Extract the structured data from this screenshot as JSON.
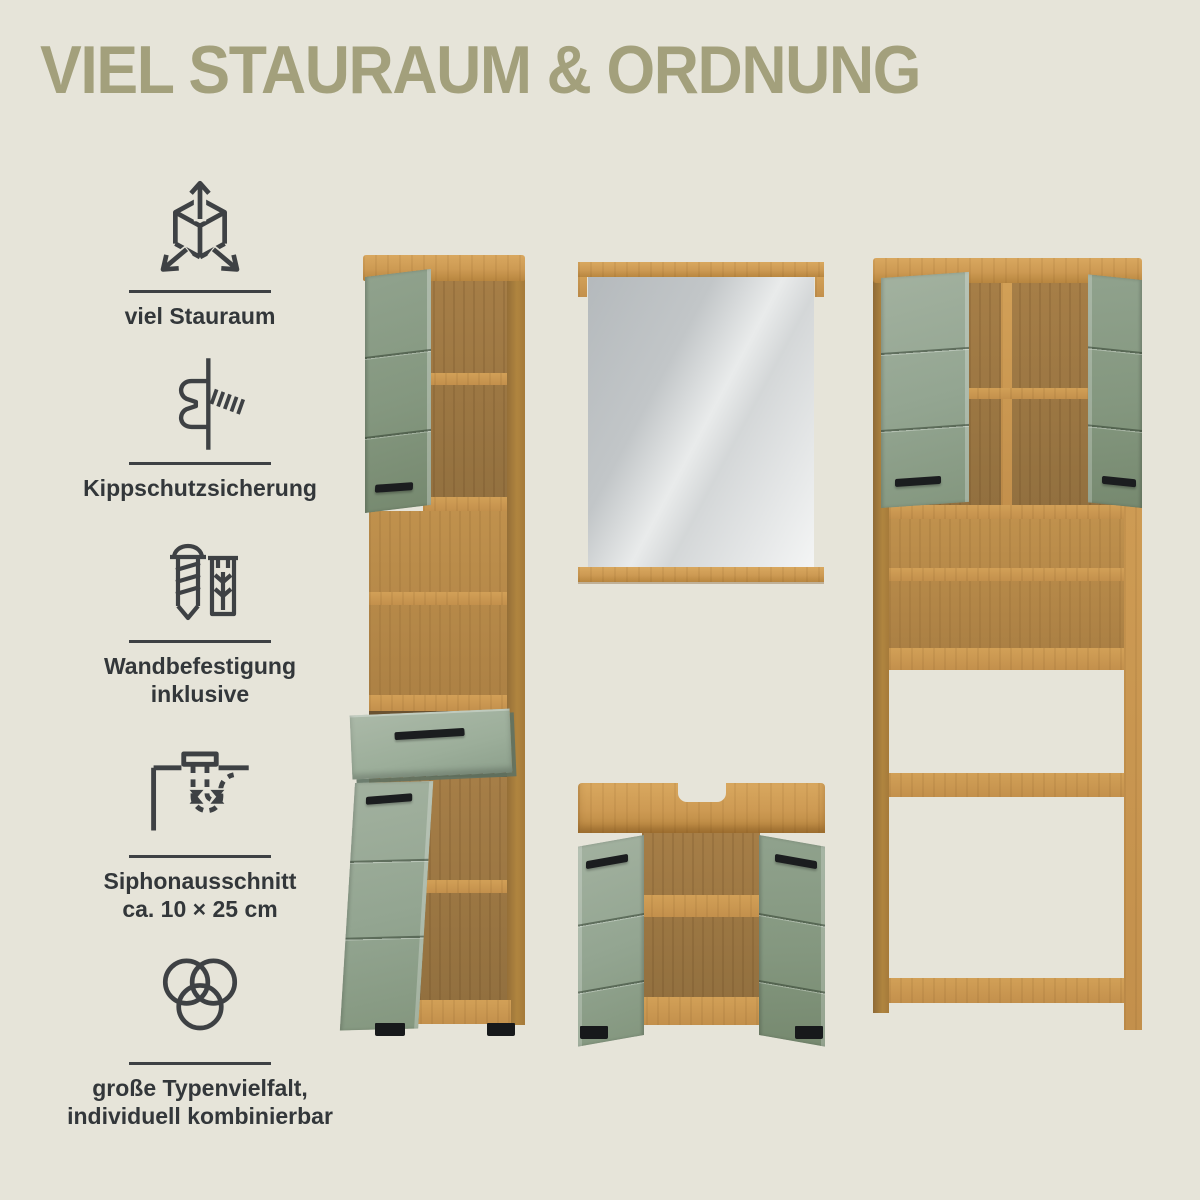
{
  "title": "VIEL STAURAUM & ORDNUNG",
  "features": [
    {
      "icon": "cube-arrows-icon",
      "lines": [
        "viel Stauraum"
      ]
    },
    {
      "icon": "anti-tip-lock-icon",
      "lines": [
        "Kippschutzsicherung"
      ]
    },
    {
      "icon": "screw-dowel-icon",
      "lines": [
        "Wandbefestigung",
        "inklusive"
      ]
    },
    {
      "icon": "siphon-cutout-icon",
      "lines": [
        "Siphonausschnitt",
        "ca. 10 × 25 cm"
      ]
    },
    {
      "icon": "venn-circles-icon",
      "lines": [
        "große Typenvielfalt,",
        "individuell kombinierbar"
      ]
    }
  ],
  "products": [
    {
      "name": "tall-cabinet"
    },
    {
      "name": "wall-mirror"
    },
    {
      "name": "sink-base-cabinet"
    },
    {
      "name": "washer-surround-cabinet"
    }
  ],
  "colors": {
    "background": "#e6e4d9",
    "title": "#a3a07c",
    "text": "#33373a",
    "oak": "#c9954f",
    "sage_green": "#93a691",
    "handle_black": "#1b1d1f"
  }
}
